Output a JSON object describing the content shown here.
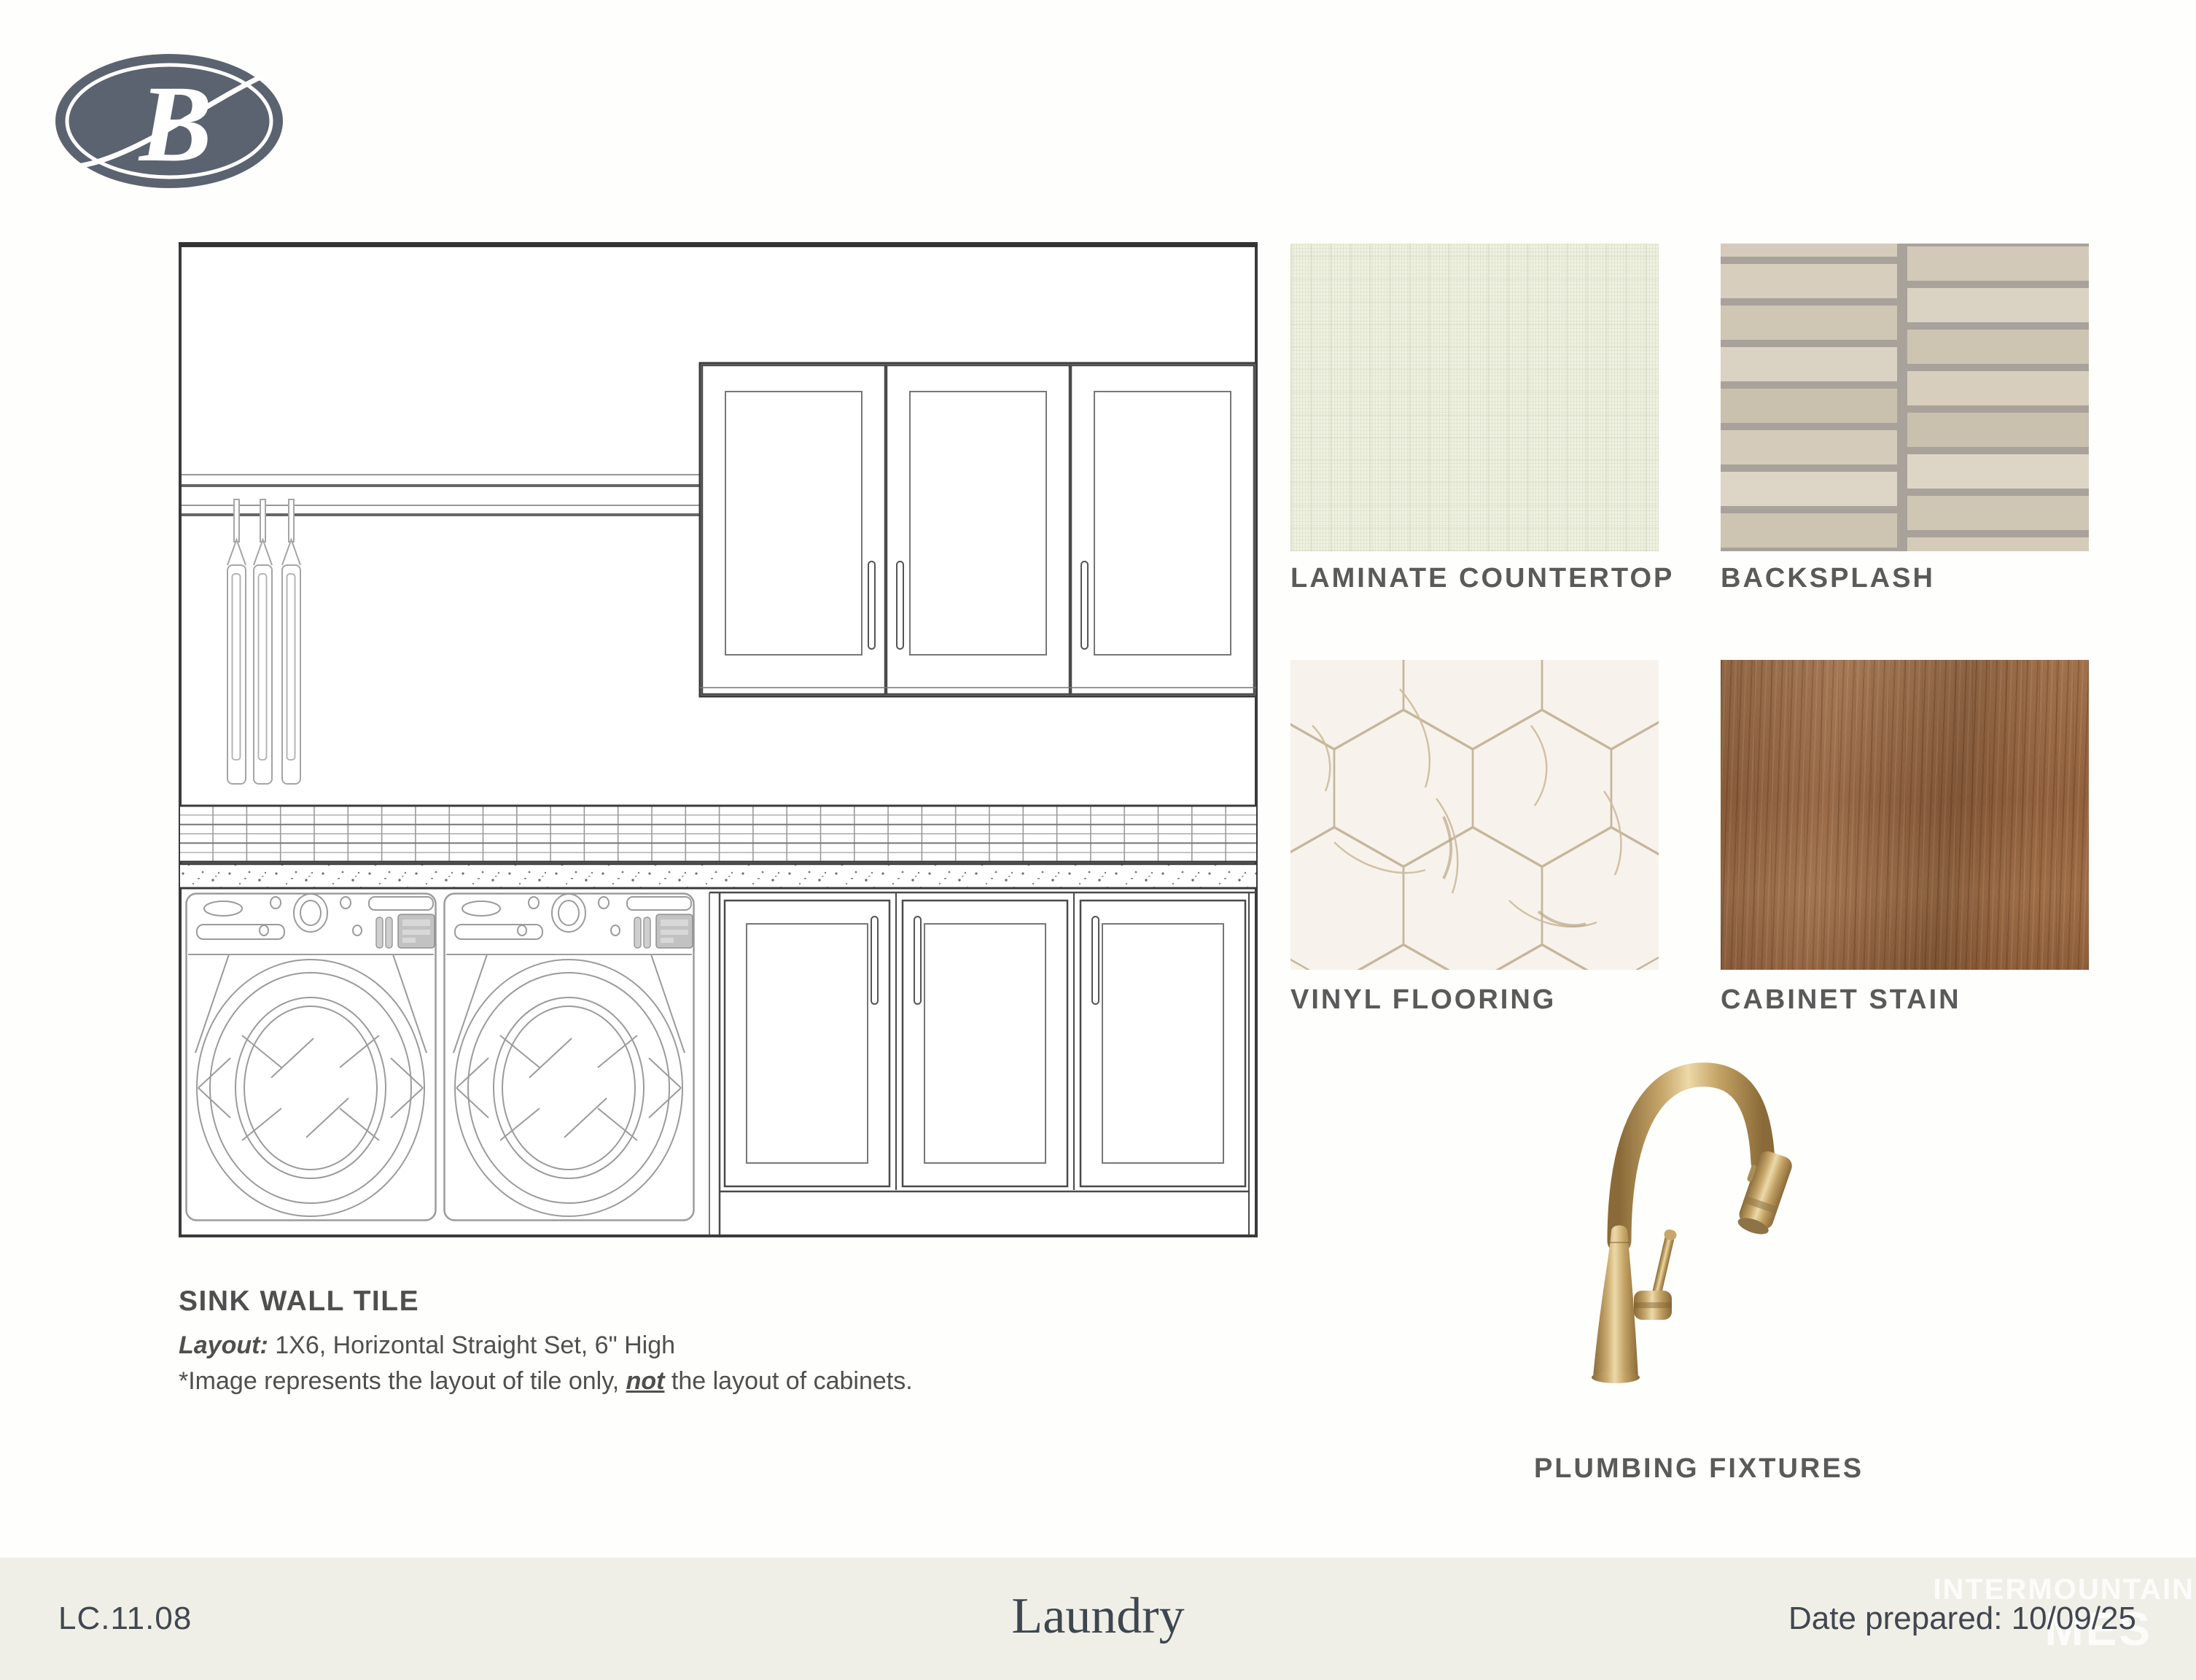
{
  "brand": {
    "logo_letter": "B"
  },
  "drawing": {
    "caption_title": "SINK WALL TILE",
    "layout_label": "Layout:",
    "layout_value": " 1X6, Horizontal Straight Set, 6\" High",
    "note_prefix": "*Image represents the layout of tile only, ",
    "note_bold": "not",
    "note_suffix": " the layout of cabinets."
  },
  "swatches": [
    {
      "label": "LAMINATE COUNTERTOP"
    },
    {
      "label": "BACKSPLASH"
    },
    {
      "label": "VINYL FLOORING"
    },
    {
      "label": "CABINET STAIN"
    }
  ],
  "plumbing_label": "PLUMBING FIXTURES",
  "footer": {
    "code": "LC.11.08",
    "title": "Laundry",
    "date": "Date prepared: 10/09/25",
    "watermark_top": "INTERMOUNTAIN",
    "watermark_bottom": "MES"
  },
  "colors": {
    "frame_stroke": "#3a3a3a",
    "machine_stroke": "#9b9b9b",
    "label_gray": "#5a5a5a",
    "logo_navy": "#5b6370",
    "footer_bg": "#f0efe7",
    "laminate": "#eff1e1",
    "grout": "#a8a29b",
    "backsplash_tiles": [
      "#d7cebd",
      "#cfc6b4",
      "#dad2c2",
      "#c9c0ae",
      "#d4cbba",
      "#ddd5c6",
      "#cdc4b2",
      "#d2c9b8"
    ],
    "vinyl_bg": "#f7f3ec",
    "vinyl_vein": "#c6b69c",
    "wood": "#96653f",
    "brass": "#c2a166"
  }
}
